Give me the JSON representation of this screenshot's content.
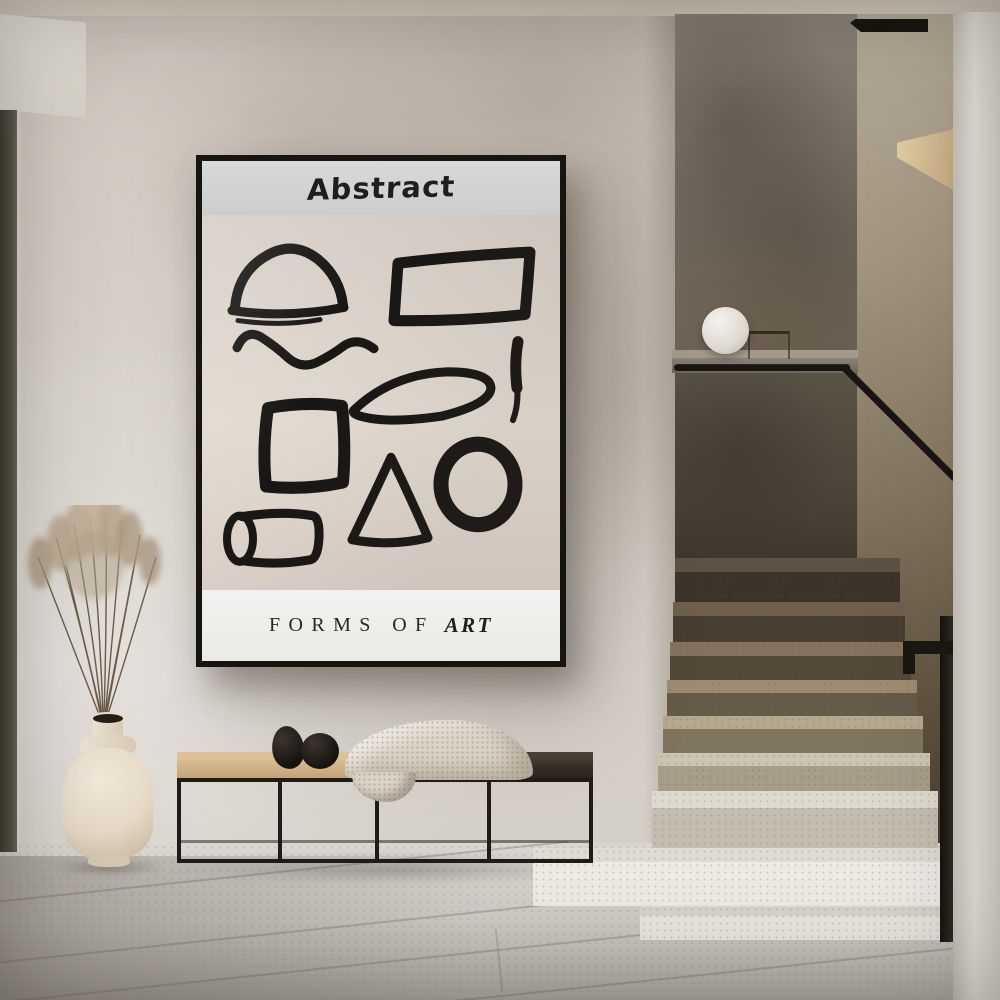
{
  "poster": {
    "title": "Abstract",
    "subtitle_regular": "FORMS OF",
    "subtitle_italic": "ART",
    "shapes": [
      "semicircle",
      "rectangle",
      "wave",
      "ellipse",
      "brush-stroke",
      "square",
      "triangle",
      "circle",
      "cylinder"
    ]
  },
  "colors": {
    "poster_frame": "#17150f",
    "poster_band": "#d8d9d9",
    "poster_canvas": "#e2dad0",
    "poster_footer": "#f2f1ef",
    "poster_ink": "#191715",
    "wall": "#d5cfc7",
    "feature_wall": "#746c60",
    "right_wall": "#83755f",
    "column": "#edeae4",
    "handrail": "#181613",
    "step_dark": "#544839",
    "step_light": "#edebe4",
    "floor": "#cdcac3",
    "bench_oak": "#cfb286",
    "bench_dark": "#2a241e",
    "bench_frame": "#1f1c17",
    "blanket": "#dcd4c6",
    "pebble": "#16130f",
    "vase": "#ecdfcd",
    "grass": "#b3a089",
    "lamp": "#f5f3ee"
  }
}
